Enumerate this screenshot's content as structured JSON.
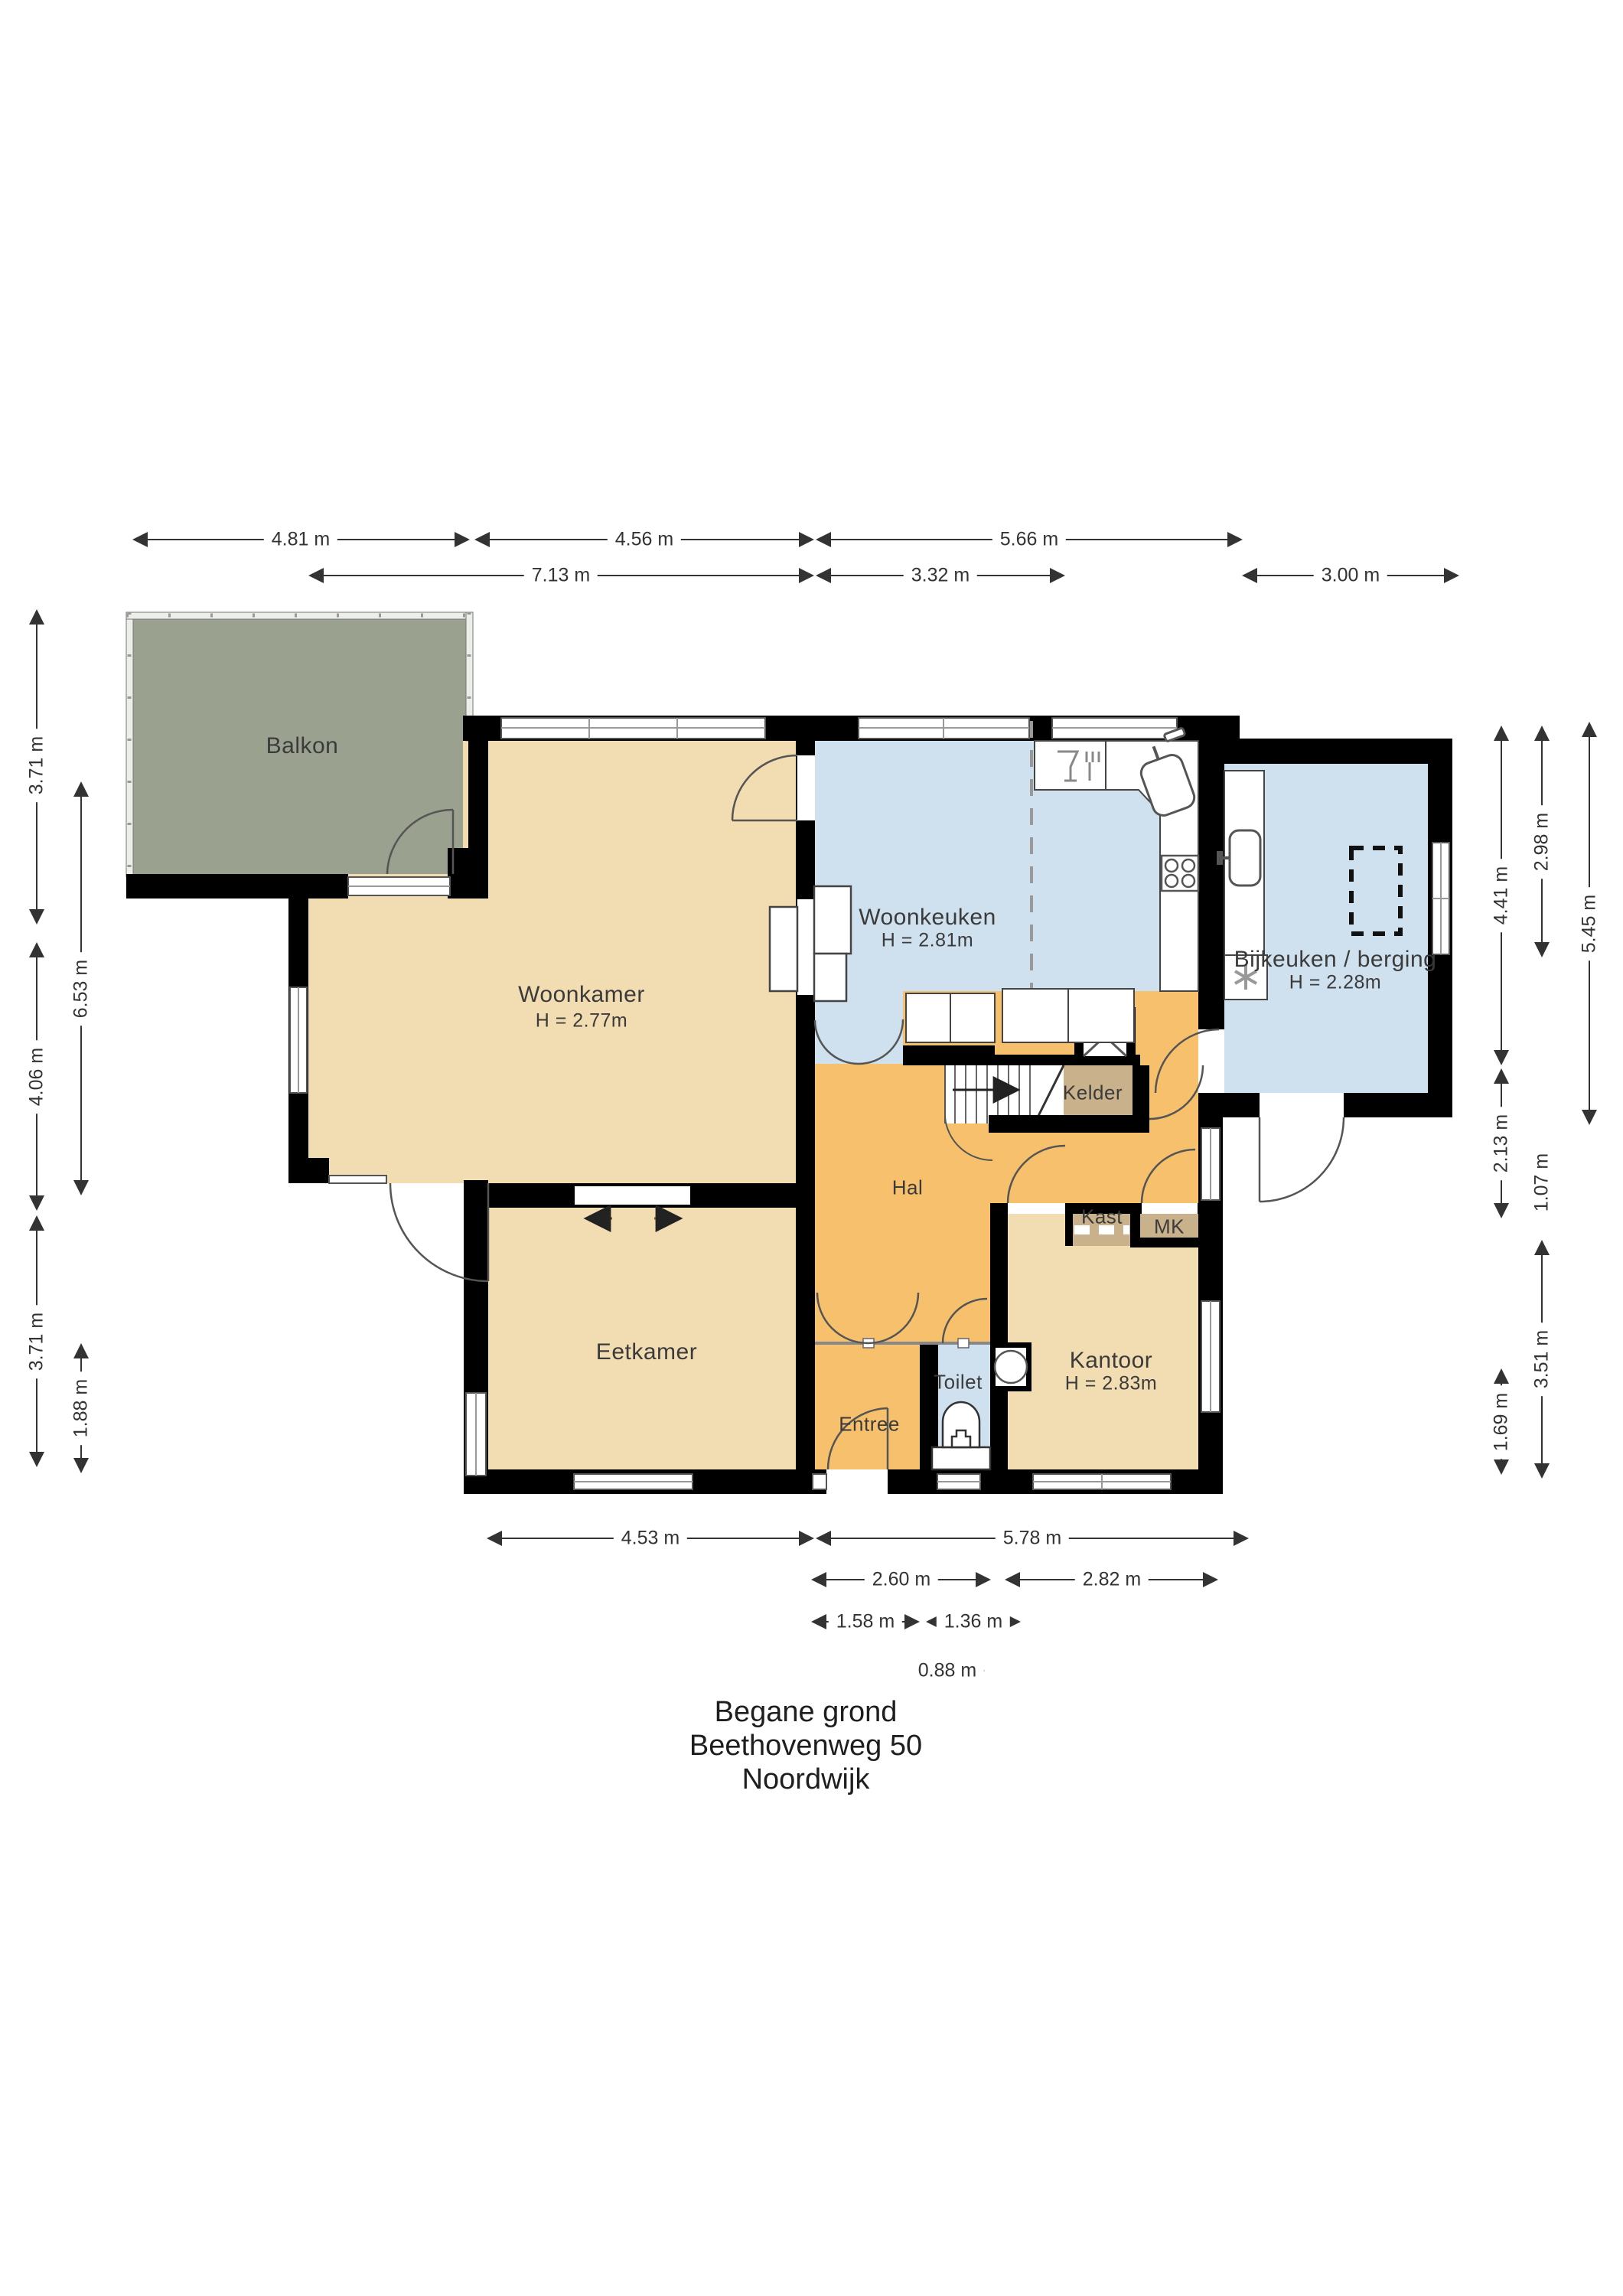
{
  "title": {
    "line1": "Begane grond",
    "line2": "Beethovenweg 50",
    "line3": "Noordwijk"
  },
  "rooms": {
    "balkon": {
      "name": "Balkon"
    },
    "woonkamer": {
      "name": "Woonkamer",
      "height": "H = 2.77m"
    },
    "woonkeuken": {
      "name": "Woonkeuken",
      "height": "H = 2.81m"
    },
    "bijkeuken": {
      "name": "Bijkeuken / berging",
      "height": "H = 2.28m"
    },
    "kelder": {
      "name": "Kelder"
    },
    "hal": {
      "name": "Hal"
    },
    "kast": {
      "name": "Kast"
    },
    "mk": {
      "name": "MK"
    },
    "eetkamer": {
      "name": "Eetkamer"
    },
    "entree": {
      "name": "Entree"
    },
    "toilet": {
      "name": "Toilet"
    },
    "kantoor": {
      "name": "Kantoor",
      "height": "H = 2.83m"
    }
  },
  "dimensions": {
    "top": {
      "d481": "4.81 m",
      "d456": "4.56 m",
      "d566": "5.66 m",
      "d713": "7.13 m",
      "d332": "3.32 m",
      "d300": "3.00 m"
    },
    "left": {
      "d371a": "3.71 m",
      "d406": "4.06 m",
      "d371b": "3.71 m",
      "d653": "6.53 m",
      "d188": "1.88 m"
    },
    "right": {
      "d441": "4.41 m",
      "d213": "2.13 m",
      "d169": "1.69 m",
      "d298": "2.98 m",
      "d107": "1.07 m",
      "d351": "3.51 m",
      "d545": "5.45 m"
    },
    "bottom": {
      "d453": "4.53 m",
      "d578": "5.78 m",
      "d260": "2.60 m",
      "d282": "2.82 m",
      "d158": "1.58 m",
      "d136": "1.36 m",
      "d088": "0.88 m"
    }
  },
  "colors": {
    "wall": "#000000",
    "living": "#f2dcb2",
    "wet": "#cfe0ee",
    "hall": "#f6c06d",
    "storage": "#c9b28b",
    "balcony": "#9ba18f"
  }
}
